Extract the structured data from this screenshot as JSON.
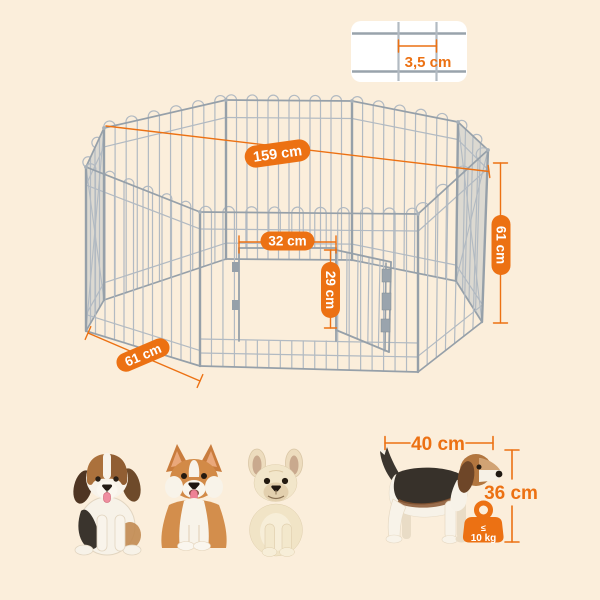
{
  "page": {
    "background": "#fbeedb"
  },
  "colors": {
    "accent": "#ec7113",
    "wire": "#b2bac2",
    "wire_frame": "#96a0a9",
    "panel_ghost_fill": "#b6bec6",
    "inset_background": "#ffffff",
    "label_text": "#ffffff"
  },
  "detail_inset": {
    "wire_gap_label": "3,5 cm"
  },
  "playpen": {
    "diameter_label": "159 cm",
    "panel_width_label": "61 cm",
    "panel_height_label": "61 cm",
    "door_width_label": "32 cm",
    "door_height_label": "29 cm"
  },
  "size_guide": {
    "dog_length_label": "40 cm",
    "dog_height_label": "36 cm",
    "weight_limit_symbol": "≤",
    "weight_limit_label": "10 kg"
  },
  "illustrations": {
    "dogs_left_group": [
      "beagle-puppy",
      "corgi",
      "french-bulldog"
    ],
    "size_reference_dog": "beagle",
    "weight_icon": "kettlebell-weight-icon"
  }
}
